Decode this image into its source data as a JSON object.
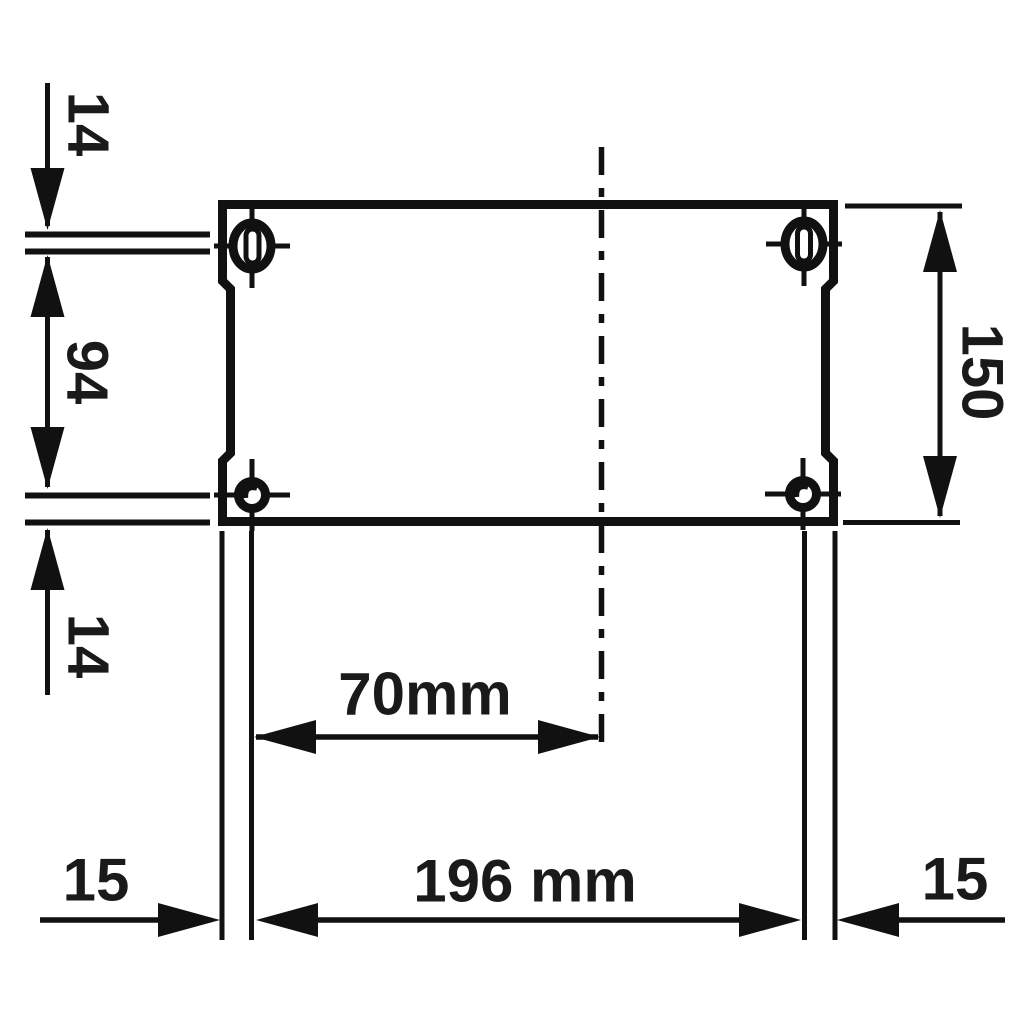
{
  "meta": {
    "background_color": "#ffffff",
    "line_color": "#111111",
    "text_color": "#1a1a1a",
    "drawing_type": "dimensioned mounting-plate technical drawing"
  },
  "labels": {
    "top_left_offset": "14",
    "left_hole_spacing": "94",
    "bottom_left_offset": "14",
    "height": "150",
    "hole_to_centerline": "70mm",
    "hole_spacing_width": "196 mm",
    "edge_margin_left": "15",
    "edge_margin_right": "15"
  }
}
